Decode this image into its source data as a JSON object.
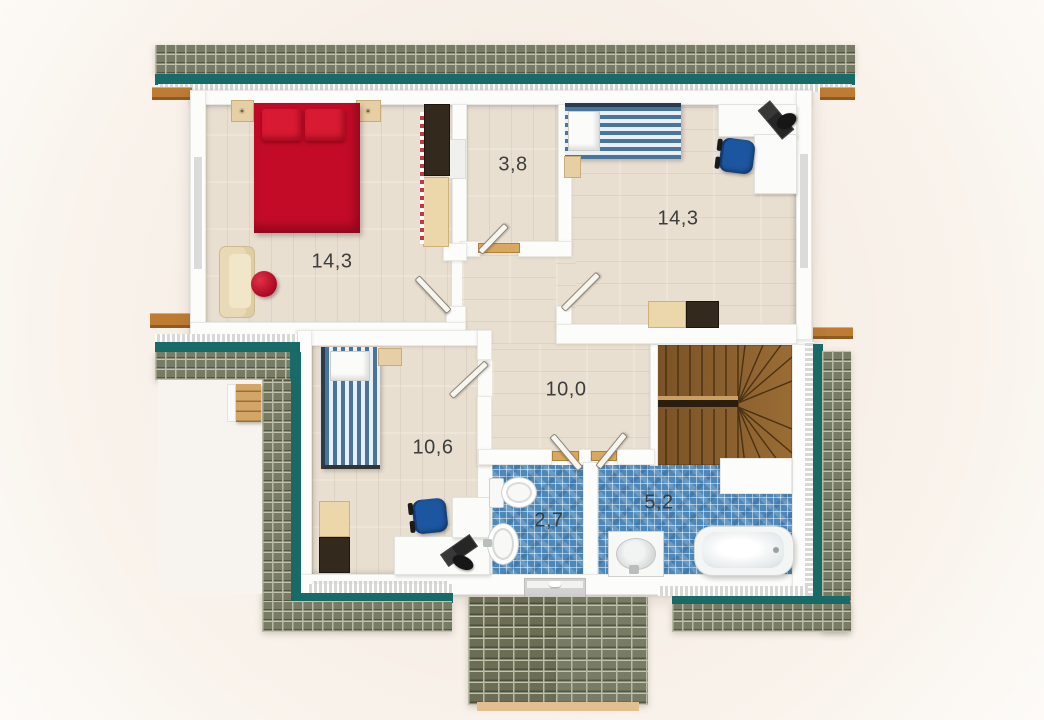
{
  "plan": {
    "type": "floor-plan",
    "storey": "upper floor with pitched roof",
    "rooms": [
      {
        "id": "bedroom-left",
        "kind": "bedroom",
        "area_label": "14,3"
      },
      {
        "id": "closet",
        "kind": "storage",
        "area_label": "3,8"
      },
      {
        "id": "bedroom-right",
        "kind": "bedroom",
        "area_label": "14,3"
      },
      {
        "id": "hallway",
        "kind": "hallway",
        "area_label": "10,0"
      },
      {
        "id": "bedroom-lower",
        "kind": "bedroom",
        "area_label": "10,6"
      },
      {
        "id": "wc",
        "kind": "toilet",
        "area_label": "2,7"
      },
      {
        "id": "bathroom",
        "kind": "bathroom",
        "area_label": "5,2"
      }
    ],
    "furniture": {
      "bedroom-left": [
        "double-bed-red",
        "nightstand",
        "nightstand",
        "wardrobe",
        "sofa",
        "pouf-red"
      ],
      "bedroom-right": [
        "single-bed-striped",
        "nightstand",
        "desk",
        "office-chair-blue",
        "laptop",
        "desk-lamp",
        "cabinet"
      ],
      "bedroom-lower": [
        "single-bed-striped",
        "nightstand",
        "desk",
        "office-chair-blue",
        "laptop",
        "desk-lamp",
        "cabinet"
      ],
      "wc": [
        "toilet",
        "wash-basin"
      ],
      "bathroom": [
        "bathtub",
        "vanity-basin"
      ],
      "hallway": [
        "staircase-winder"
      ]
    },
    "colors": {
      "roof_tile_olive": "#797c64",
      "roof_band_teal": "#186b68",
      "wall_white": "#fcfcfb",
      "floor_wood_light": "#e9dfd1",
      "bath_mosaic_blue": "#4d88b8",
      "bed_red": "#c30b28",
      "bed_stripe_blue": "#47759e",
      "office_chair_blue": "#1c56a0",
      "stair_wood_brown": "#8a5f2d",
      "beam_orange_wood": "#bd7b33",
      "threshold_tan": "#d9a75e",
      "label_gray": "#3d3d3d"
    }
  }
}
